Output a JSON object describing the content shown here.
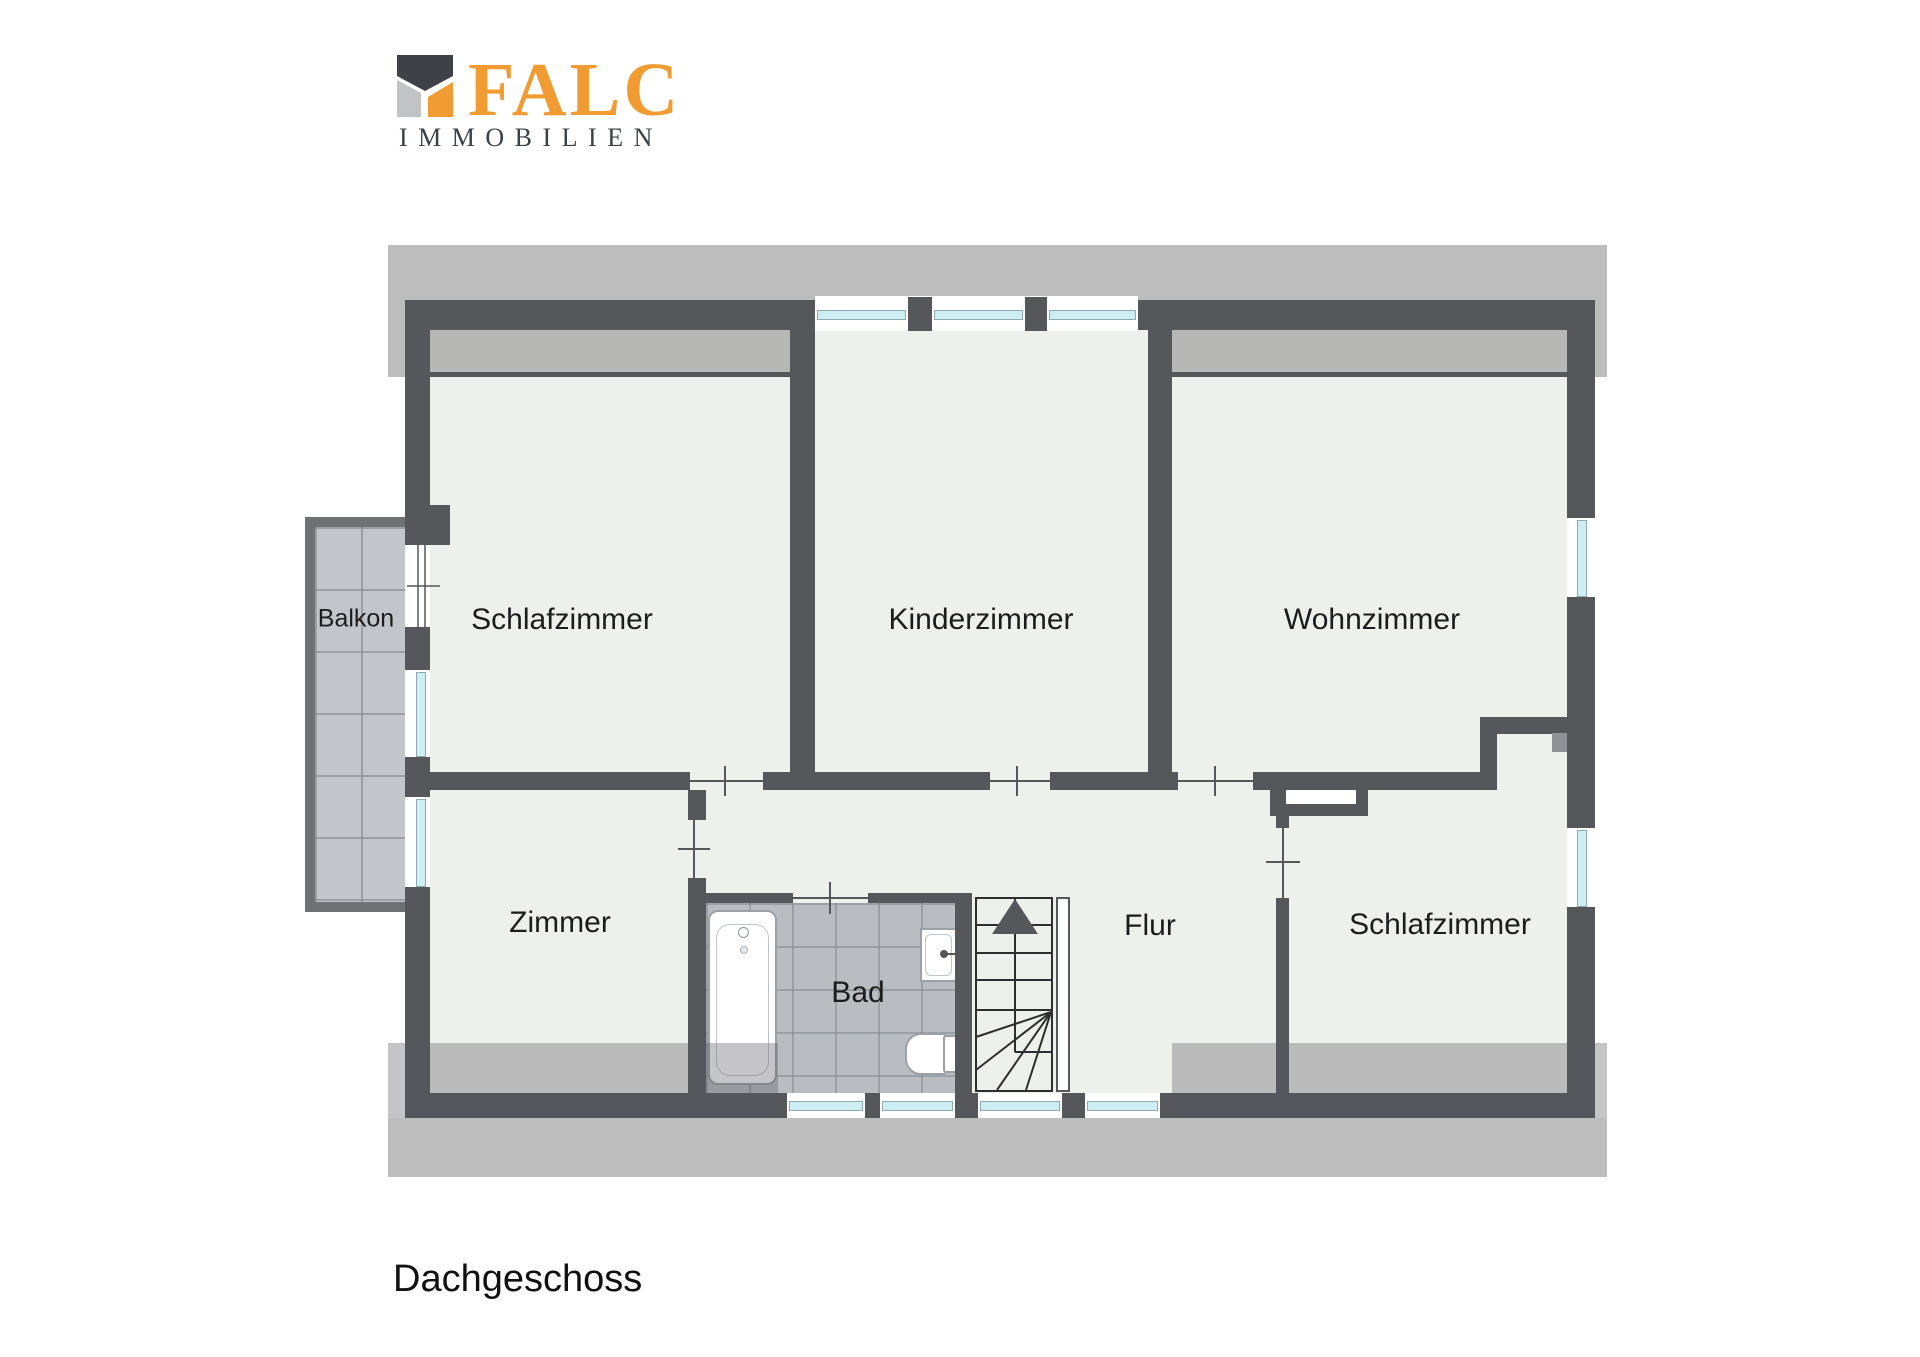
{
  "logo": {
    "brand": "FALC",
    "subtitle": "IMMOBILIEN"
  },
  "floor_label": "Dachgeschoss",
  "rooms": {
    "balkon": "Balkon",
    "schlafzimmer_left": "Schlafzimmer",
    "kinderzimmer": "Kinderzimmer",
    "wohnzimmer": "Wohnzimmer",
    "zimmer": "Zimmer",
    "bad": "Bad",
    "flur": "Flur",
    "schlafzimmer_right": "Schlafzimmer"
  },
  "colors": {
    "wall": "#55575b",
    "roof_band": "#bdbdbd",
    "floor": "#eef0eb",
    "inner_band": "#b7b8b5",
    "tile_bad": "#b9bdc1",
    "tile_balkon": "#c2c6ca",
    "balkon_frame": "#6f7275",
    "window_glass": "#cdeef3",
    "logo_orange": "#f09c33",
    "logo_dark": "#3e4247",
    "logo_gray": "#c2c3c5",
    "text": "#1c1c1c"
  }
}
